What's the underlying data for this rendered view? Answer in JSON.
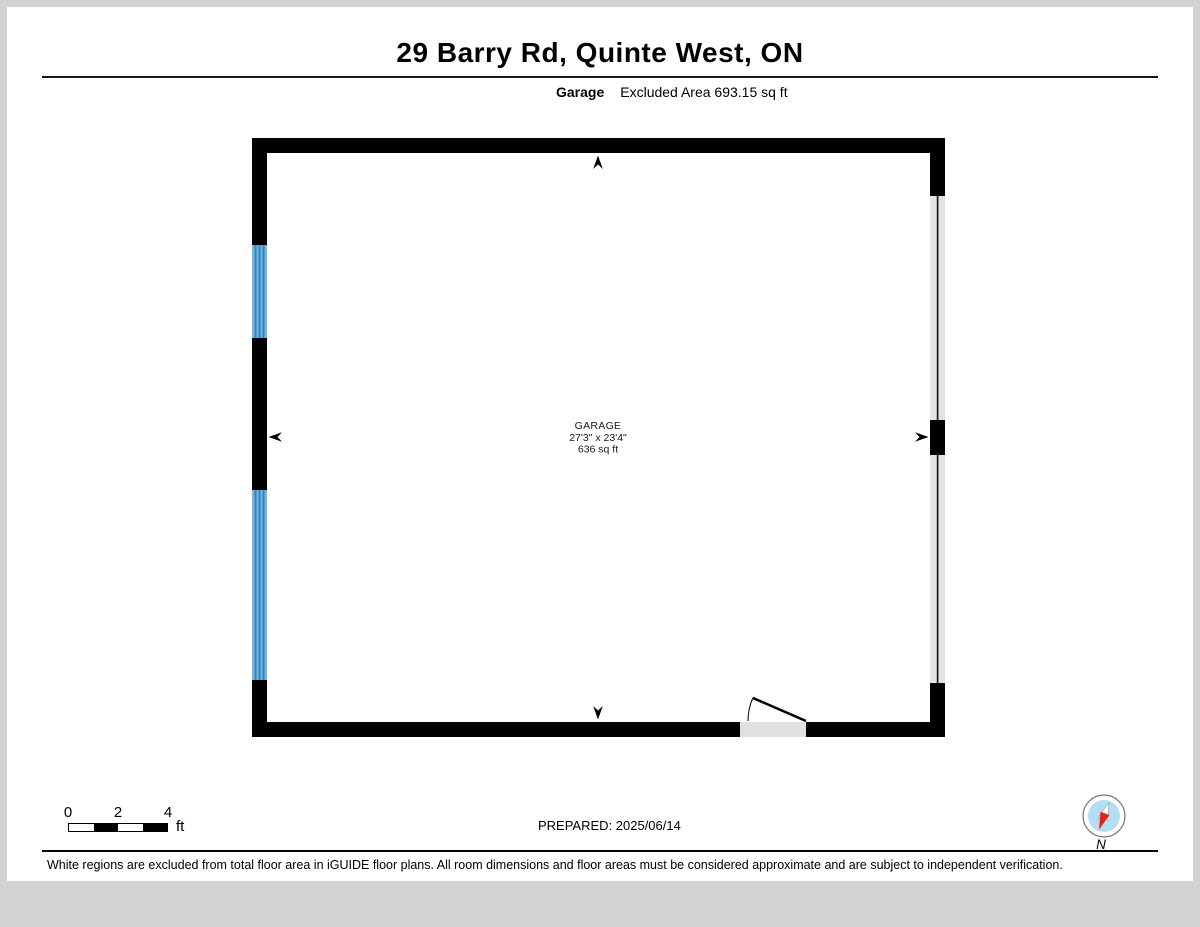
{
  "header": {
    "title": "29 Barry Rd, Quinte West, ON",
    "floor_label": "Garage",
    "excluded_area": "Excluded Area 693.15 sq ft"
  },
  "plan": {
    "room": {
      "name": "GARAGE",
      "dimensions": "27'3\" x 23'4\"",
      "area": "636 sq ft"
    }
  },
  "footer": {
    "scale": {
      "ticks": [
        "0",
        "2",
        "4"
      ],
      "unit": "ft"
    },
    "prepared": "PREPARED: 2025/06/14",
    "compass_label": "N",
    "disclaimer": "White regions are excluded from total floor area in iGUIDE floor plans. All room dimensions and floor areas must be considered approximate and are subject to independent verification."
  },
  "colors": {
    "wall": "#000000",
    "window_blue": "#72b5de",
    "window_stripe": "#3484bd",
    "garage_door_gray": "#e3e3e3",
    "opening_gray": "#e0e0e0",
    "compass_blue": "#b4ddf1",
    "compass_red": "#e02518",
    "page_margin_gray": "#d2d2d2"
  }
}
